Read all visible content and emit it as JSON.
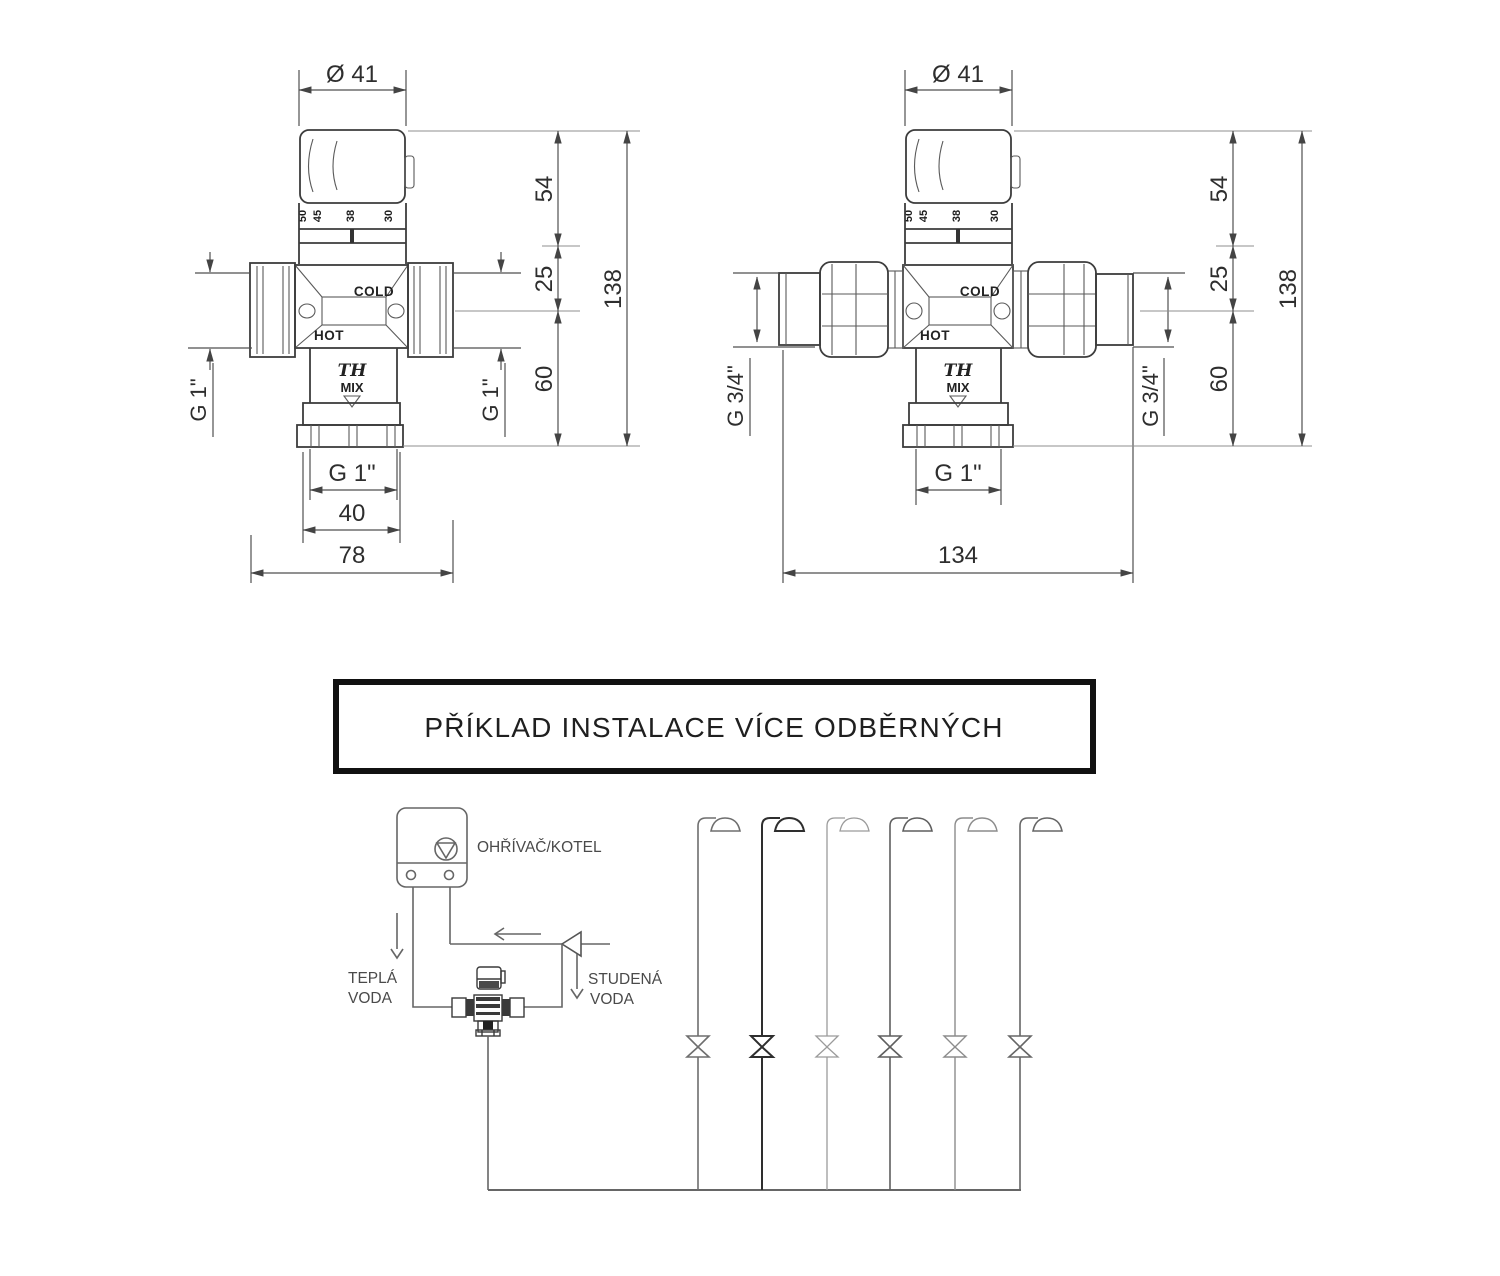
{
  "valve_left": {
    "diameter_label": "Ø 41",
    "scale_marks": [
      "50",
      "45",
      "38",
      "30"
    ],
    "cold_label": "COLD",
    "hot_label": "HOT",
    "brand_label": "TH",
    "mix_label": "MIX",
    "side_port_left": "G 1\"",
    "side_port_right": "G 1\"",
    "dim_knob_height": "54",
    "dim_body_height": "25",
    "dim_total_height": "138",
    "dim_lower_height": "60",
    "outlet_thread": "G 1\"",
    "dim_outlet_width": "40",
    "dim_overall_width": "78"
  },
  "valve_right": {
    "diameter_label": "Ø 41",
    "scale_marks": [
      "50",
      "45",
      "38",
      "30"
    ],
    "cold_label": "COLD",
    "hot_label": "HOT",
    "brand_label": "TH",
    "mix_label": "MIX",
    "side_port_left": "G 3/4\"",
    "side_port_right": "G 3/4\"",
    "dim_knob_height": "54",
    "dim_body_height": "25",
    "dim_total_height": "138",
    "dim_lower_height": "60",
    "outlet_thread": "G 1\"",
    "dim_overall_width": "134"
  },
  "title_box": {
    "title": "PŘÍKLAD INSTALACE VÍCE ODBĚRNÝCH"
  },
  "schematic": {
    "boiler_label": "OHŘÍVAČ/KOTEL",
    "hot_water_label": [
      "TEPLÁ",
      "VODA"
    ],
    "cold_water_label": [
      "STUDENÁ",
      "VODA"
    ],
    "shower_count": 6
  }
}
